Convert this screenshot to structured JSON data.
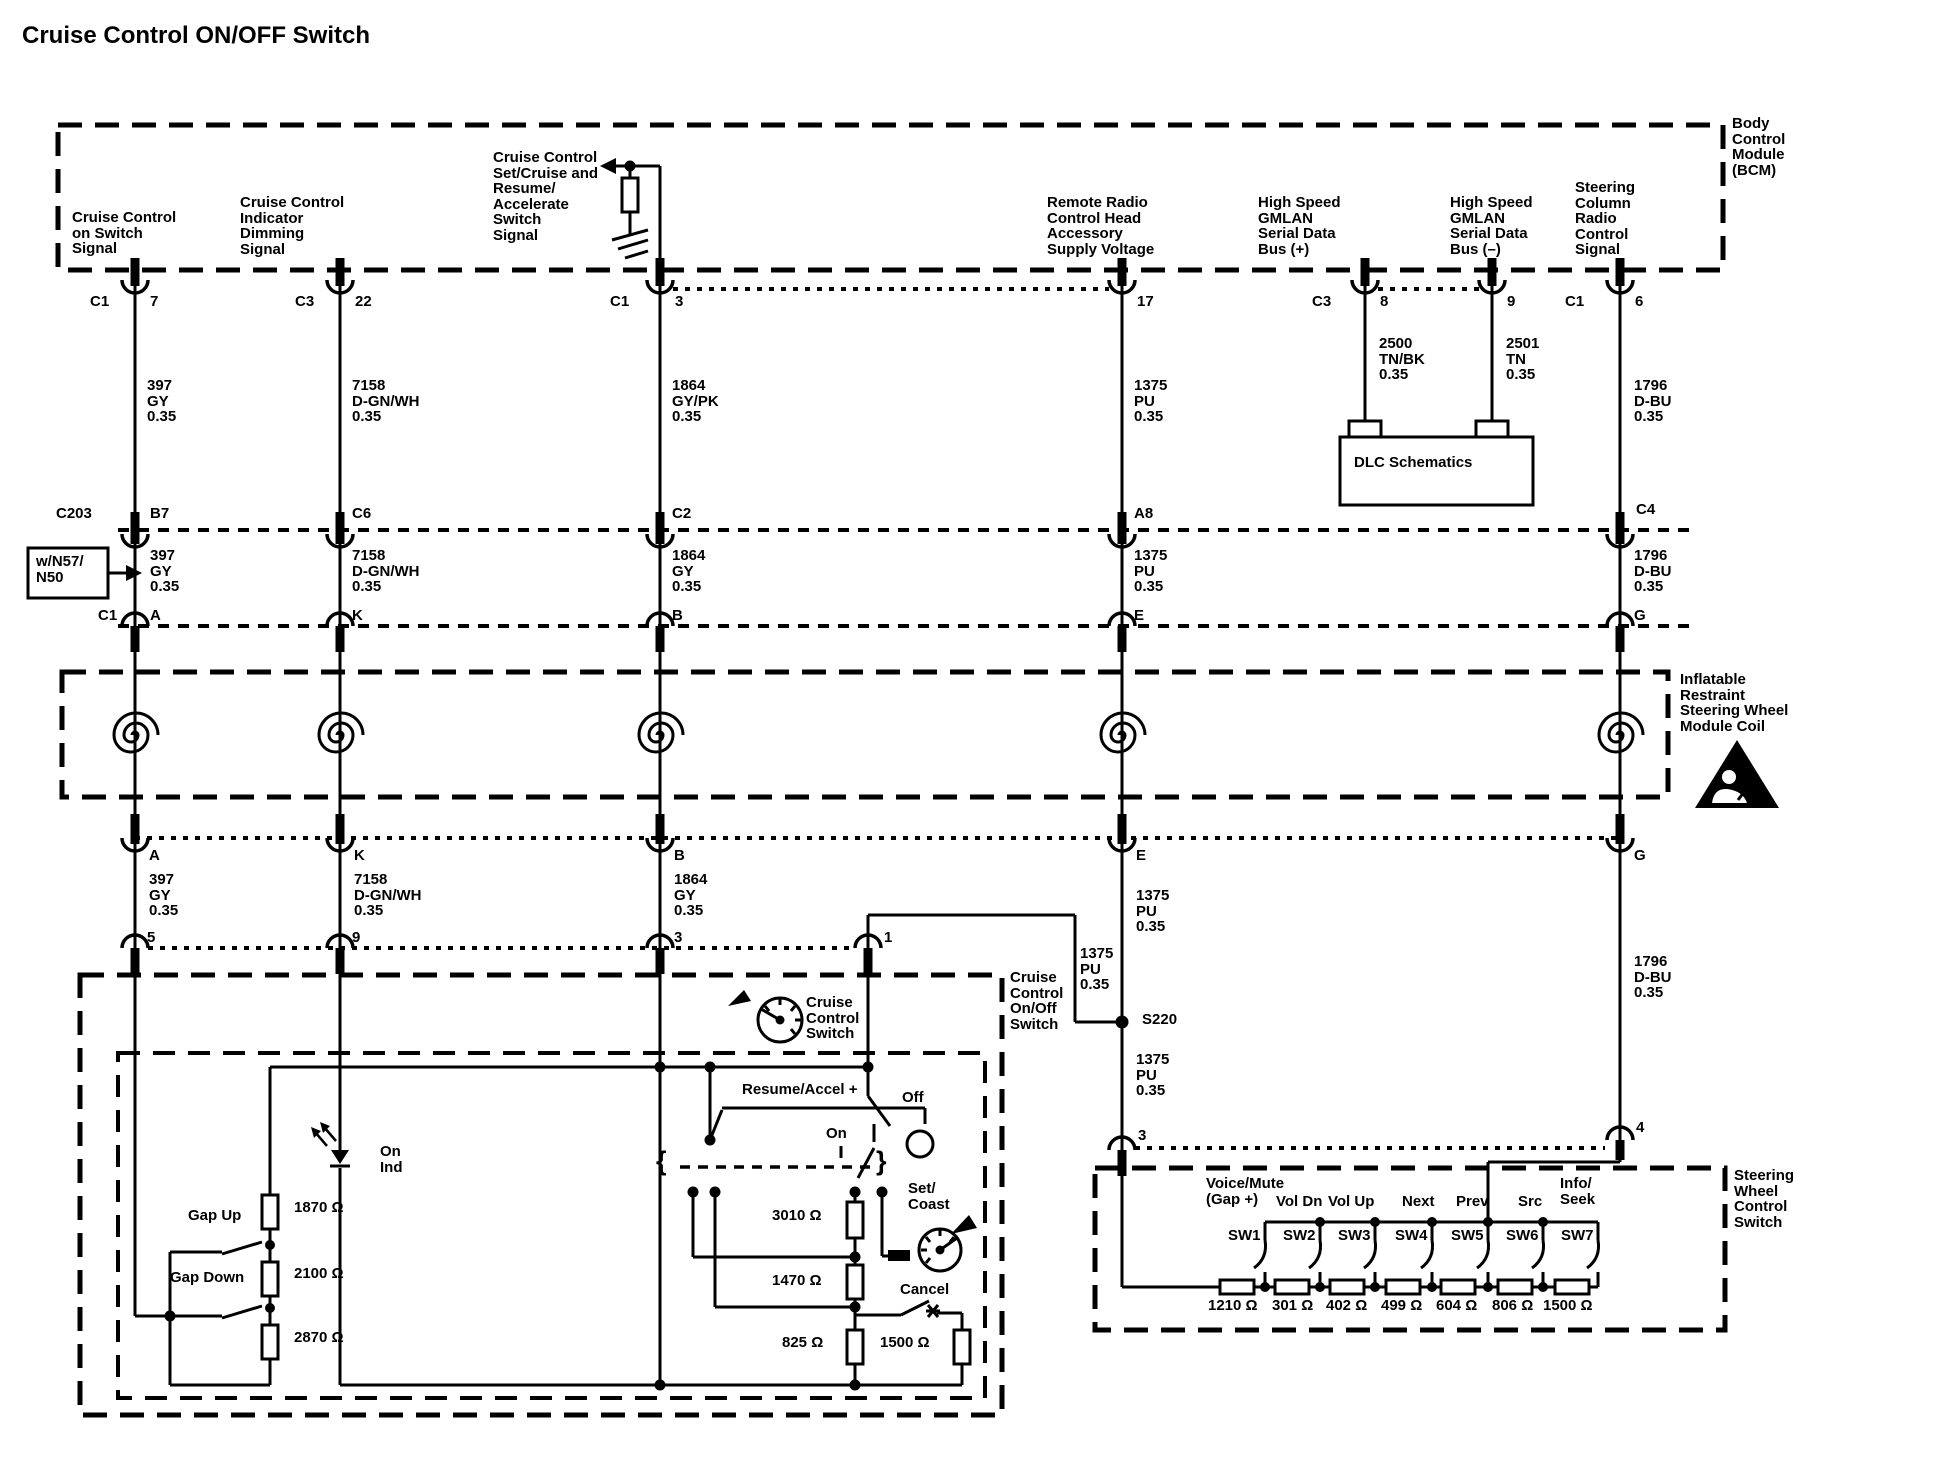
{
  "title": "Cruise Control ON/OFF Switch",
  "colors": {
    "ink": "#000000",
    "paper": "#ffffff"
  },
  "labels": [
    {
      "id": "bcm-name",
      "x": 1732,
      "y": 116,
      "text": "Body\nControl\nModule\n(BCM)"
    },
    {
      "id": "bcm-pin-cruise-on",
      "x": 72,
      "y": 210,
      "text": "Cruise Control\non Switch\nSignal"
    },
    {
      "id": "bcm-pin-indicator",
      "x": 240,
      "y": 195,
      "text": "Cruise Control\nIndicator\nDimming\nSignal"
    },
    {
      "id": "bcm-pin-setcruise",
      "x": 493,
      "y": 150,
      "text": "Cruise Control\nSet/Cruise and\nResume/\nAccelerate\nSwitch\nSignal"
    },
    {
      "id": "bcm-pin-remote-radio",
      "x": 1047,
      "y": 195,
      "text": "Remote Radio\nControl Head\nAccessory\nSupply Voltage"
    },
    {
      "id": "bcm-pin-gmlan-plus",
      "x": 1258,
      "y": 195,
      "text": "High Speed\nGMLAN\nSerial Data\nBus (+)"
    },
    {
      "id": "bcm-pin-gmlan-minus",
      "x": 1450,
      "y": 195,
      "text": "High Speed\nGMLAN\nSerial Data\nBus (–)"
    },
    {
      "id": "bcm-pin-steering",
      "x": 1575,
      "y": 180,
      "text": "Steering\nColumn\nRadio\nControl\nSignal"
    },
    {
      "id": "conn-c1-7-c",
      "x": 90,
      "y": 294,
      "text": "C1"
    },
    {
      "id": "conn-c1-7-p",
      "x": 150,
      "y": 294,
      "text": "7"
    },
    {
      "id": "conn-c3-22-c",
      "x": 295,
      "y": 294,
      "text": "C3"
    },
    {
      "id": "conn-c3-22-p",
      "x": 355,
      "y": 294,
      "text": "22"
    },
    {
      "id": "conn-c1-3-c",
      "x": 610,
      "y": 294,
      "text": "C1"
    },
    {
      "id": "conn-c1-3-p",
      "x": 675,
      "y": 294,
      "text": "3"
    },
    {
      "id": "conn-17-p",
      "x": 1137,
      "y": 294,
      "text": "17"
    },
    {
      "id": "conn-c3-8-c",
      "x": 1312,
      "y": 294,
      "text": "C3"
    },
    {
      "id": "conn-c3-8-p",
      "x": 1380,
      "y": 294,
      "text": "8"
    },
    {
      "id": "conn-9-p",
      "x": 1507,
      "y": 294,
      "text": "9"
    },
    {
      "id": "conn-c1-6-c",
      "x": 1565,
      "y": 294,
      "text": "C1"
    },
    {
      "id": "conn-c1-6-p",
      "x": 1635,
      "y": 294,
      "text": "6"
    },
    {
      "id": "wire1-397",
      "x": 147,
      "y": 378,
      "text": "397\nGY\n0.35"
    },
    {
      "id": "wire1-7158",
      "x": 352,
      "y": 378,
      "text": "7158\nD-GN/WH\n0.35"
    },
    {
      "id": "wire1-1864",
      "x": 672,
      "y": 378,
      "text": "1864\nGY/PK\n0.35"
    },
    {
      "id": "wire1-1375",
      "x": 1134,
      "y": 378,
      "text": "1375\nPU\n0.35"
    },
    {
      "id": "wire1-2500",
      "x": 1379,
      "y": 336,
      "text": "2500\nTN/BK\n0.35"
    },
    {
      "id": "wire1-2501",
      "x": 1506,
      "y": 336,
      "text": "2501\nTN\n0.35"
    },
    {
      "id": "wire1-1796",
      "x": 1634,
      "y": 378,
      "text": "1796\nD-BU\n0.35"
    },
    {
      "id": "dlc",
      "x": 1354,
      "y": 455,
      "text": "DLC Schematics"
    },
    {
      "id": "c203",
      "x": 56,
      "y": 506,
      "text": "C203"
    },
    {
      "id": "c203-b7",
      "x": 150,
      "y": 506,
      "text": "B7"
    },
    {
      "id": "c203-c6",
      "x": 352,
      "y": 506,
      "text": "C6"
    },
    {
      "id": "c203-c2",
      "x": 672,
      "y": 506,
      "text": "C2"
    },
    {
      "id": "c203-a8",
      "x": 1134,
      "y": 506,
      "text": "A8"
    },
    {
      "id": "c203-c4",
      "x": 1636,
      "y": 502,
      "text": "C4"
    },
    {
      "id": "n57",
      "x": 36,
      "y": 554,
      "text": "w/N57/\nN50"
    },
    {
      "id": "wire2-397",
      "x": 150,
      "y": 548,
      "text": "397\nGY\n0.35"
    },
    {
      "id": "wire2-7158",
      "x": 352,
      "y": 548,
      "text": "7158\nD-GN/WH\n0.35"
    },
    {
      "id": "wire2-1864",
      "x": 672,
      "y": 548,
      "text": "1864\nGY\n0.35"
    },
    {
      "id": "wire2-1375",
      "x": 1134,
      "y": 548,
      "text": "1375\nPU\n0.35"
    },
    {
      "id": "wire2-1796",
      "x": 1634,
      "y": 548,
      "text": "1796\nD-BU\n0.35"
    },
    {
      "id": "coilrow-c1",
      "x": 98,
      "y": 608,
      "text": "C1"
    },
    {
      "id": "coilrow-a",
      "x": 150,
      "y": 608,
      "text": "A"
    },
    {
      "id": "coilrow-k",
      "x": 352,
      "y": 608,
      "text": "K"
    },
    {
      "id": "coilrow-b",
      "x": 672,
      "y": 608,
      "text": "B"
    },
    {
      "id": "coilrow-e",
      "x": 1134,
      "y": 608,
      "text": "E"
    },
    {
      "id": "coilrow-g",
      "x": 1634,
      "y": 608,
      "text": "G"
    },
    {
      "id": "coil-name",
      "x": 1680,
      "y": 672,
      "text": "Inflatable\nRestraint\nSteering Wheel\nModule Coil"
    },
    {
      "id": "row4-a",
      "x": 149,
      "y": 848,
      "text": "A"
    },
    {
      "id": "row4-k",
      "x": 354,
      "y": 848,
      "text": "K"
    },
    {
      "id": "row4-b",
      "x": 674,
      "y": 848,
      "text": "B"
    },
    {
      "id": "row4-e",
      "x": 1136,
      "y": 848,
      "text": "E"
    },
    {
      "id": "row4-g",
      "x": 1634,
      "y": 848,
      "text": "G"
    },
    {
      "id": "wire3-397",
      "x": 149,
      "y": 872,
      "text": "397\nGY\n0.35"
    },
    {
      "id": "wire3-7158",
      "x": 354,
      "y": 872,
      "text": "7158\nD-GN/WH\n0.35"
    },
    {
      "id": "wire3-1864",
      "x": 674,
      "y": 872,
      "text": "1864\nGY\n0.35"
    },
    {
      "id": "wire3-1375",
      "x": 1136,
      "y": 888,
      "text": "1375\nPU\n0.35"
    },
    {
      "id": "wire3-1796",
      "x": 1634,
      "y": 954,
      "text": "1796\nD-BU\n0.35"
    },
    {
      "id": "pin-5",
      "x": 147,
      "y": 930,
      "text": "5"
    },
    {
      "id": "pin-9",
      "x": 352,
      "y": 930,
      "text": "9"
    },
    {
      "id": "pin-3",
      "x": 674,
      "y": 930,
      "text": "3"
    },
    {
      "id": "pin-1",
      "x": 884,
      "y": 930,
      "text": "1"
    },
    {
      "id": "branch-1375",
      "x": 1080,
      "y": 946,
      "text": "1375\nPU\n0.35"
    },
    {
      "id": "s220",
      "x": 1142,
      "y": 1012,
      "text": "S220"
    },
    {
      "id": "cc-onoff-switch",
      "x": 1010,
      "y": 970,
      "text": "Cruise\nControl\nOn/Off\nSwitch"
    },
    {
      "id": "s220-1375",
      "x": 1136,
      "y": 1052,
      "text": "1375\nPU\n0.35"
    },
    {
      "id": "pin-3b",
      "x": 1138,
      "y": 1128,
      "text": "3"
    },
    {
      "id": "pin-4",
      "x": 1636,
      "y": 1120,
      "text": "4"
    },
    {
      "id": "ccs-name",
      "x": 806,
      "y": 995,
      "text": "Cruise\nControl\nSwitch"
    },
    {
      "id": "resume-accel",
      "x": 742,
      "y": 1082,
      "text": "Resume/Accel +"
    },
    {
      "id": "off",
      "x": 902,
      "y": 1090,
      "text": "Off"
    },
    {
      "id": "on",
      "x": 826,
      "y": 1126,
      "text": "On"
    },
    {
      "id": "set-coast",
      "x": 908,
      "y": 1181,
      "text": "Set/\nCoast"
    },
    {
      "id": "cancel",
      "x": 900,
      "y": 1282,
      "text": "Cancel"
    },
    {
      "id": "res-3010",
      "x": 772,
      "y": 1208,
      "text": "3010 Ω"
    },
    {
      "id": "res-1470",
      "x": 772,
      "y": 1273,
      "text": "1470 Ω"
    },
    {
      "id": "res-825",
      "x": 782,
      "y": 1335,
      "text": "825 Ω"
    },
    {
      "id": "res-1500",
      "x": 880,
      "y": 1335,
      "text": "1500 Ω"
    },
    {
      "id": "gap-up",
      "x": 188,
      "y": 1208,
      "text": "Gap Up"
    },
    {
      "id": "gap-down",
      "x": 170,
      "y": 1270,
      "text": "Gap Down"
    },
    {
      "id": "res-1870",
      "x": 294,
      "y": 1200,
      "text": "1870 Ω"
    },
    {
      "id": "res-2100",
      "x": 294,
      "y": 1266,
      "text": "2100 Ω"
    },
    {
      "id": "res-2870",
      "x": 294,
      "y": 1330,
      "text": "2870 Ω"
    },
    {
      "id": "on-ind",
      "x": 380,
      "y": 1144,
      "text": "On\nInd"
    },
    {
      "id": "swcs-name",
      "x": 1734,
      "y": 1168,
      "text": "Steering\nWheel\nControl\nSwitch"
    },
    {
      "id": "fn-voice-mute",
      "x": 1206,
      "y": 1176,
      "text": "Voice/Mute\n(Gap +)"
    },
    {
      "id": "fn-vol-dn",
      "x": 1276,
      "y": 1194,
      "text": "Vol Dn"
    },
    {
      "id": "fn-vol-up",
      "x": 1328,
      "y": 1194,
      "text": "Vol Up"
    },
    {
      "id": "fn-next",
      "x": 1402,
      "y": 1194,
      "text": "Next"
    },
    {
      "id": "fn-prev",
      "x": 1456,
      "y": 1194,
      "text": "Prev"
    },
    {
      "id": "fn-src",
      "x": 1518,
      "y": 1194,
      "text": "Src"
    },
    {
      "id": "fn-info-seek",
      "x": 1560,
      "y": 1176,
      "text": "Info/\nSeek"
    },
    {
      "id": "sw1",
      "x": 1228,
      "y": 1228,
      "text": "SW1"
    },
    {
      "id": "sw2",
      "x": 1283,
      "y": 1228,
      "text": "SW2"
    },
    {
      "id": "sw3",
      "x": 1338,
      "y": 1228,
      "text": "SW3"
    },
    {
      "id": "sw4",
      "x": 1395,
      "y": 1228,
      "text": "SW4"
    },
    {
      "id": "sw5",
      "x": 1451,
      "y": 1228,
      "text": "SW5"
    },
    {
      "id": "sw6",
      "x": 1506,
      "y": 1228,
      "text": "SW6"
    },
    {
      "id": "sw7",
      "x": 1561,
      "y": 1228,
      "text": "SW7"
    },
    {
      "id": "rv-1210",
      "x": 1208,
      "y": 1298,
      "text": "1210 Ω"
    },
    {
      "id": "rv-301",
      "x": 1272,
      "y": 1298,
      "text": "301 Ω"
    },
    {
      "id": "rv-402",
      "x": 1326,
      "y": 1298,
      "text": "402 Ω"
    },
    {
      "id": "rv-499",
      "x": 1381,
      "y": 1298,
      "text": "499 Ω"
    },
    {
      "id": "rv-604",
      "x": 1436,
      "y": 1298,
      "text": "604 Ω"
    },
    {
      "id": "rv-806",
      "x": 1492,
      "y": 1298,
      "text": "806 Ω"
    },
    {
      "id": "rv-1500",
      "x": 1543,
      "y": 1298,
      "text": "1500 Ω"
    },
    {
      "id": "gang-brace-left",
      "x": 656,
      "y": 1148,
      "text": "{",
      "size": 27
    },
    {
      "id": "gang-brace-right",
      "x": 876,
      "y": 1148,
      "text": "}",
      "size": 27
    }
  ]
}
